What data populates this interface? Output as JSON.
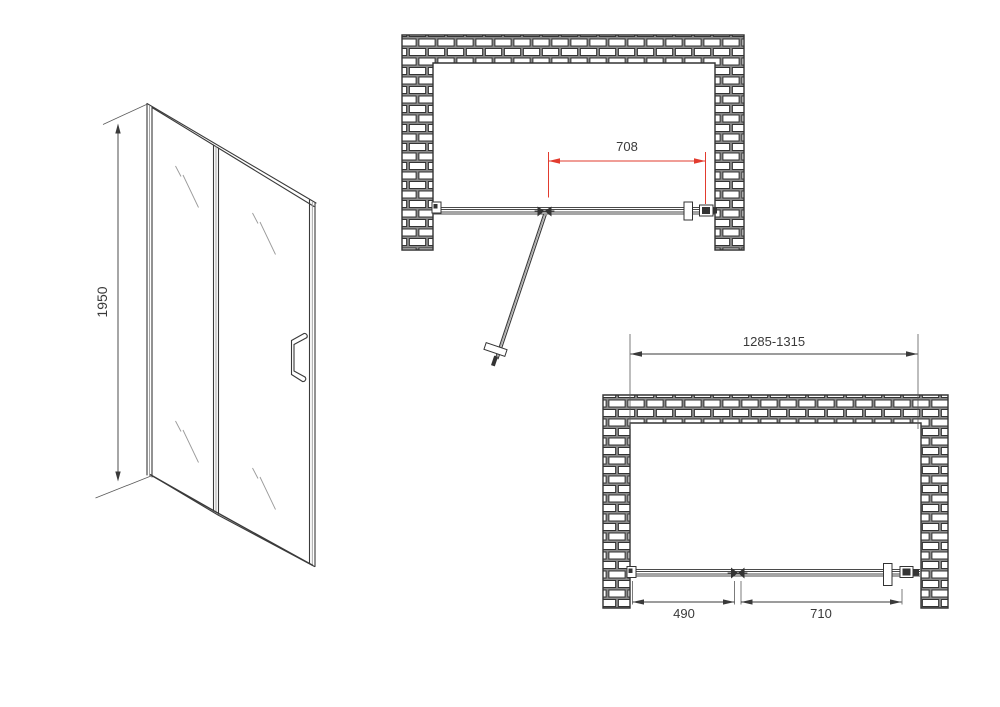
{
  "drawing": {
    "elevation": {
      "height_label": "1950"
    },
    "plan_open": {
      "door_width_label": "708"
    },
    "plan_closed": {
      "opening_range_label": "1285-1315",
      "fixed_panel_label": "490",
      "door_panel_label": "710"
    },
    "colors": {
      "line": "#3a3a3a",
      "dimension_red": "#e23b2e",
      "mortar": "#8a8a8a",
      "brick": "#ffffff"
    }
  }
}
